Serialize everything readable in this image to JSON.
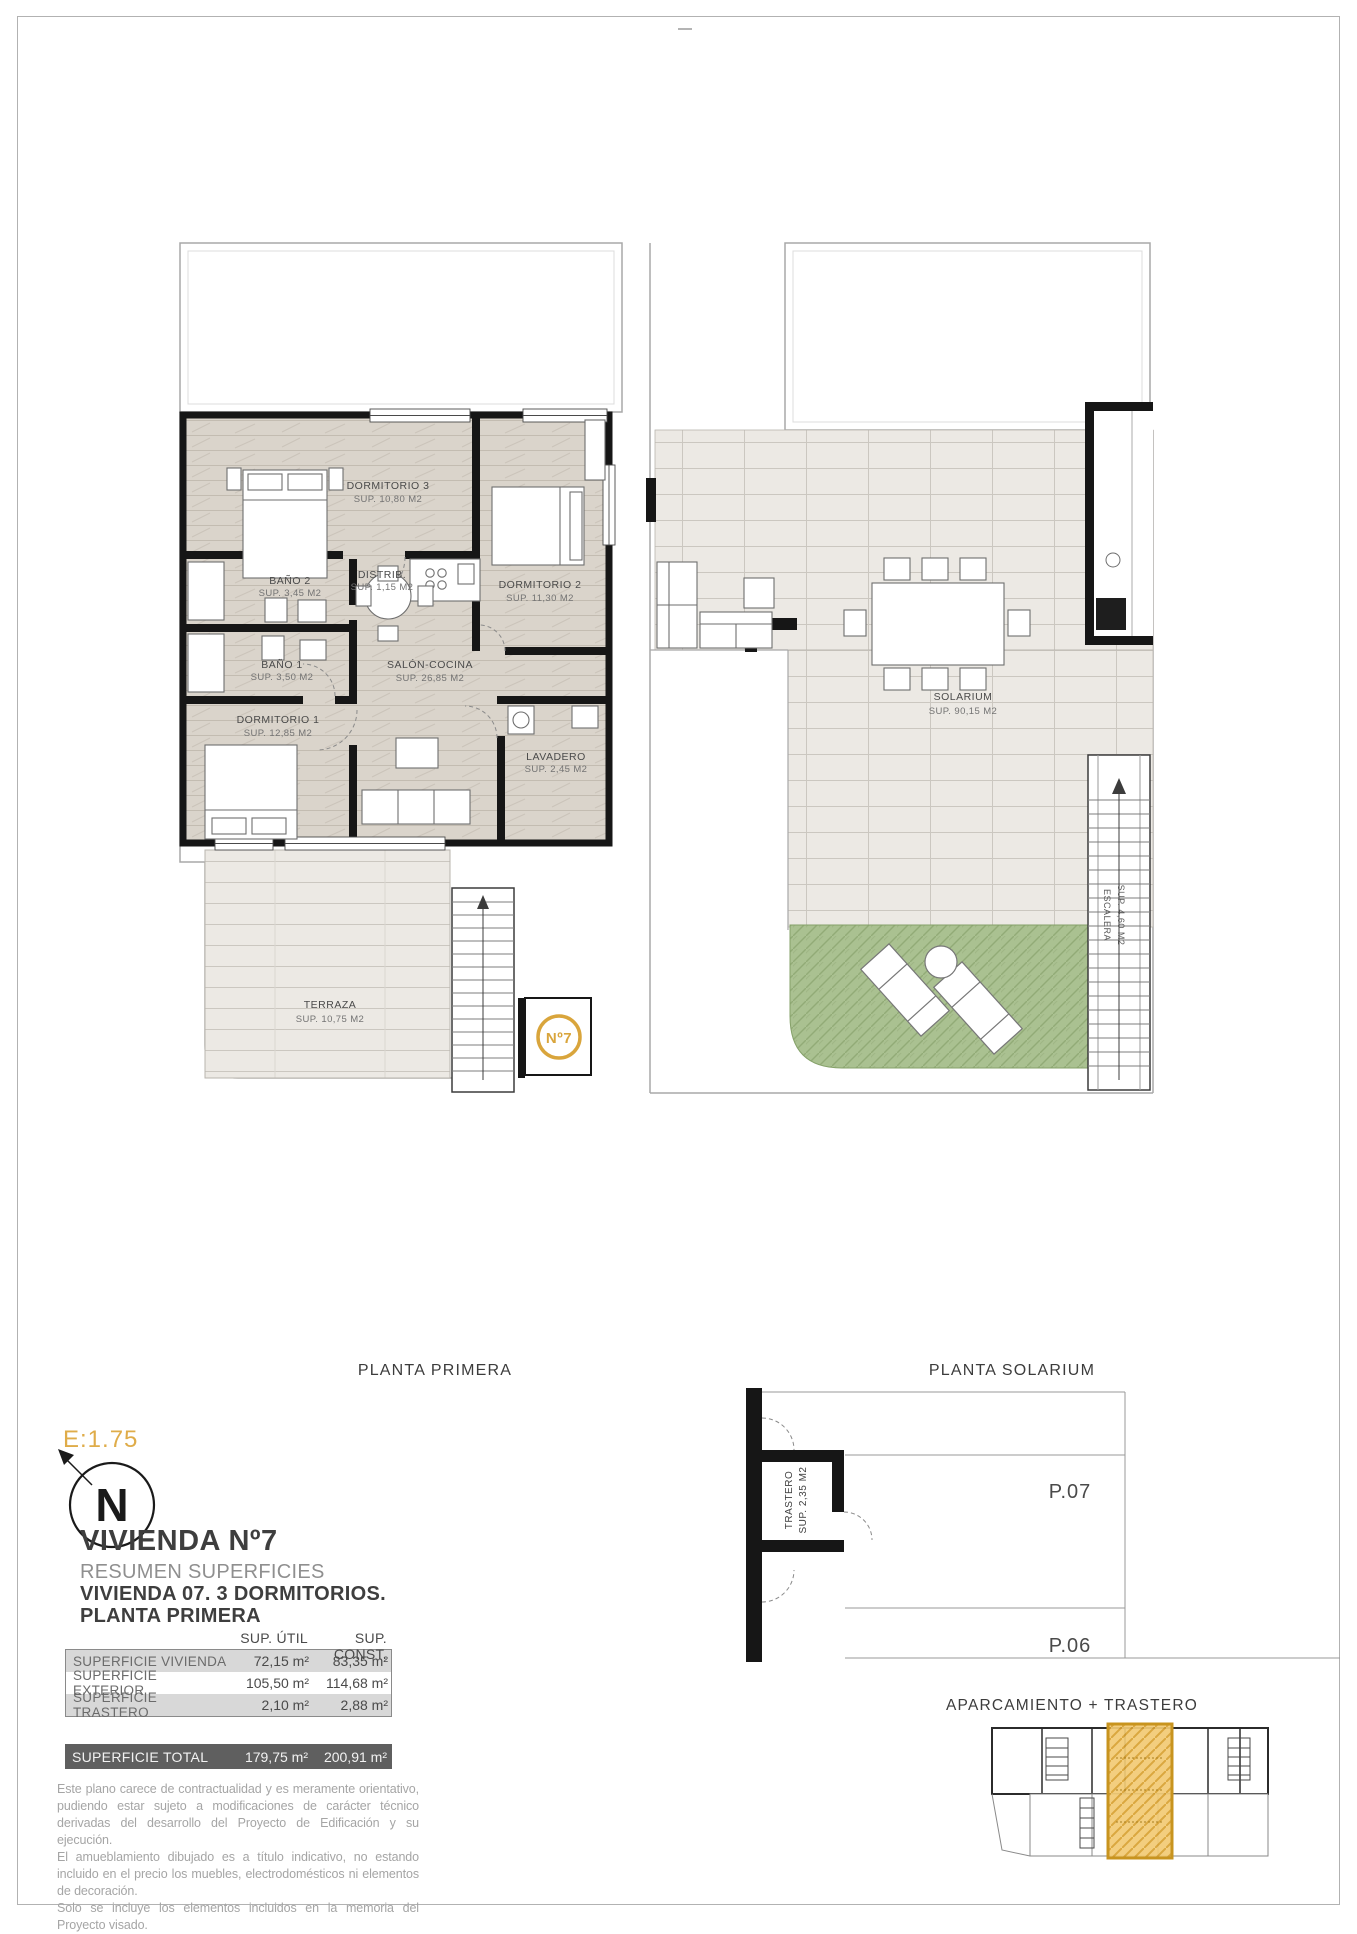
{
  "page": {
    "scale_label": "E:1.75",
    "north_letter": "N"
  },
  "plans": {
    "primera": {
      "caption": "PLANTA PRIMERA",
      "unit_marker": "Nº7",
      "rooms": {
        "dormitorio3": {
          "label": "DORMITORIO 3",
          "area": "SUP. 10,80 M2"
        },
        "dormitorio2": {
          "label": "DORMITORIO 2",
          "area": "SUP. 11,30 M2"
        },
        "bano2": {
          "label": "BAÑO 2",
          "area": "SUP. 3,45 M2"
        },
        "distribuidor": {
          "label": "DISTRIB.",
          "area": "SUP. 1,15 M2"
        },
        "bano1": {
          "label": "BAÑO 1",
          "area": "SUP. 3,50 M2"
        },
        "dormitorio1": {
          "label": "DORMITORIO 1",
          "area": "SUP. 12,85 M2"
        },
        "salon_cocina": {
          "label": "SALÓN-COCINA",
          "area": "SUP. 26,85 M2"
        },
        "lavadero": {
          "label": "LAVADERO",
          "area": "SUP. 2,45 M2"
        },
        "terraza": {
          "label": "TERRAZA",
          "area": "SUP. 10,75 M2"
        }
      }
    },
    "solarium": {
      "caption": "PLANTA SOLARIUM",
      "rooms": {
        "solarium": {
          "label": "SOLARIUM",
          "area": "SUP. 90,15 M2"
        },
        "escalera": {
          "label": "ESCALERA",
          "area": "SUP. 4,60 M2"
        }
      }
    },
    "parking": {
      "caption": "APARCAMIENTO + TRASTERO",
      "trastero_label": "TRASTERO",
      "trastero_area": "SUP. 2,35 M2",
      "space_1": "P.07",
      "space_2": "P.06"
    }
  },
  "titleblock": {
    "title": "VIVIENDA Nº7",
    "subtitle": "RESUMEN SUPERFICIES",
    "line2": "VIVIENDA 07. 3 DORMITORIOS.",
    "line3": "PLANTA PRIMERA",
    "table": {
      "col_util": "SUP. ÚTIL",
      "col_const": "SUP. CONST.",
      "rows": [
        {
          "label": "SUPERFICIE VIVIENDA",
          "util": "72,15 m²",
          "const": "83,35 m²"
        },
        {
          "label": "SUPERFICIE EXTERIOR",
          "util": "105,50 m²",
          "const": "114,68 m²"
        },
        {
          "label": "SUPERFICIE TRASTERO",
          "util": "2,10 m²",
          "const": "2,88 m²"
        }
      ],
      "total": {
        "label": "SUPERFICIE TOTAL",
        "util": "179,75 m²",
        "const": "200,91 m²"
      }
    },
    "disclaimer": [
      "Este plano carece de contractualidad y es meramente orientativo, pudiendo estar sujeto a modificaciones de carácter técnico derivadas del desarrollo del Proyecto de Edificación y su ejecución.",
      "El amueblamiento dibujado es a título indicativo, no estando incluido en el precio los muebles, electrodomésticos ni elementos de decoración.",
      "Solo se incluye los elementos incluidos en la memoria del Proyecto visado."
    ]
  },
  "colors": {
    "accent_gold": "#D9A53C",
    "wall_black": "#161616",
    "grass_green": "#AAC191",
    "table_row_gray": "#D8D8D8",
    "table_total_gray": "#5F5F5F"
  }
}
